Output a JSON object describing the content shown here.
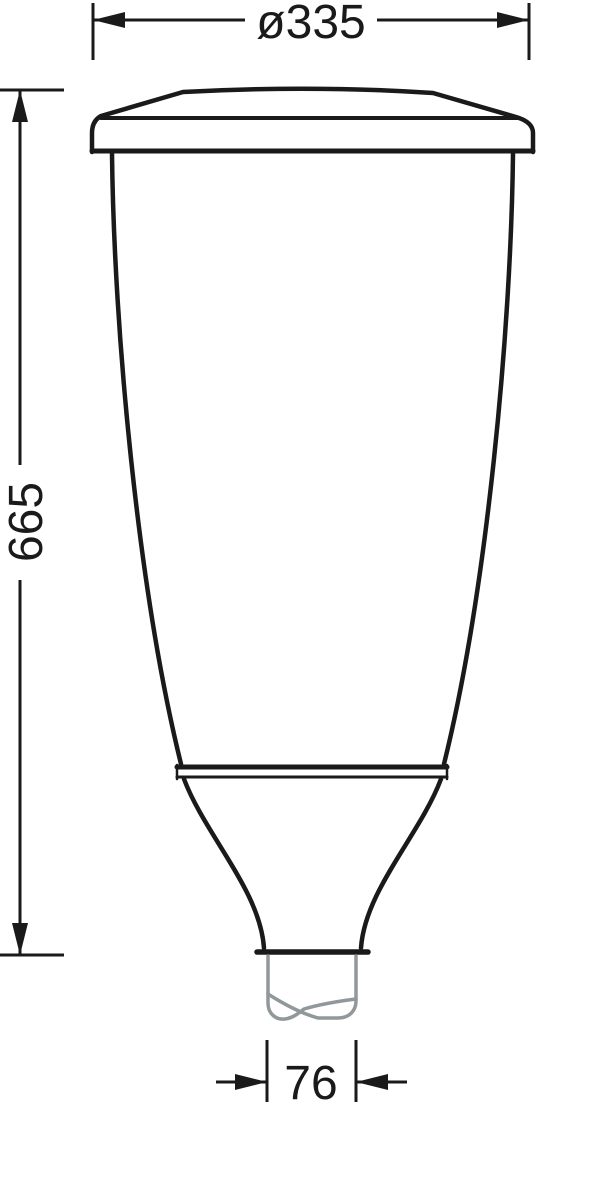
{
  "drawing": {
    "title": "luminaire-dimension-drawing",
    "dimensions": {
      "diameter": {
        "label": "ø335",
        "value": 335
      },
      "height": {
        "label": "665",
        "value": 665
      },
      "spigot_width": {
        "label": "76",
        "value": 76
      }
    },
    "colors": {
      "line": "#1a1a1a",
      "spigot": "#90989b",
      "background": "#ffffff"
    }
  }
}
